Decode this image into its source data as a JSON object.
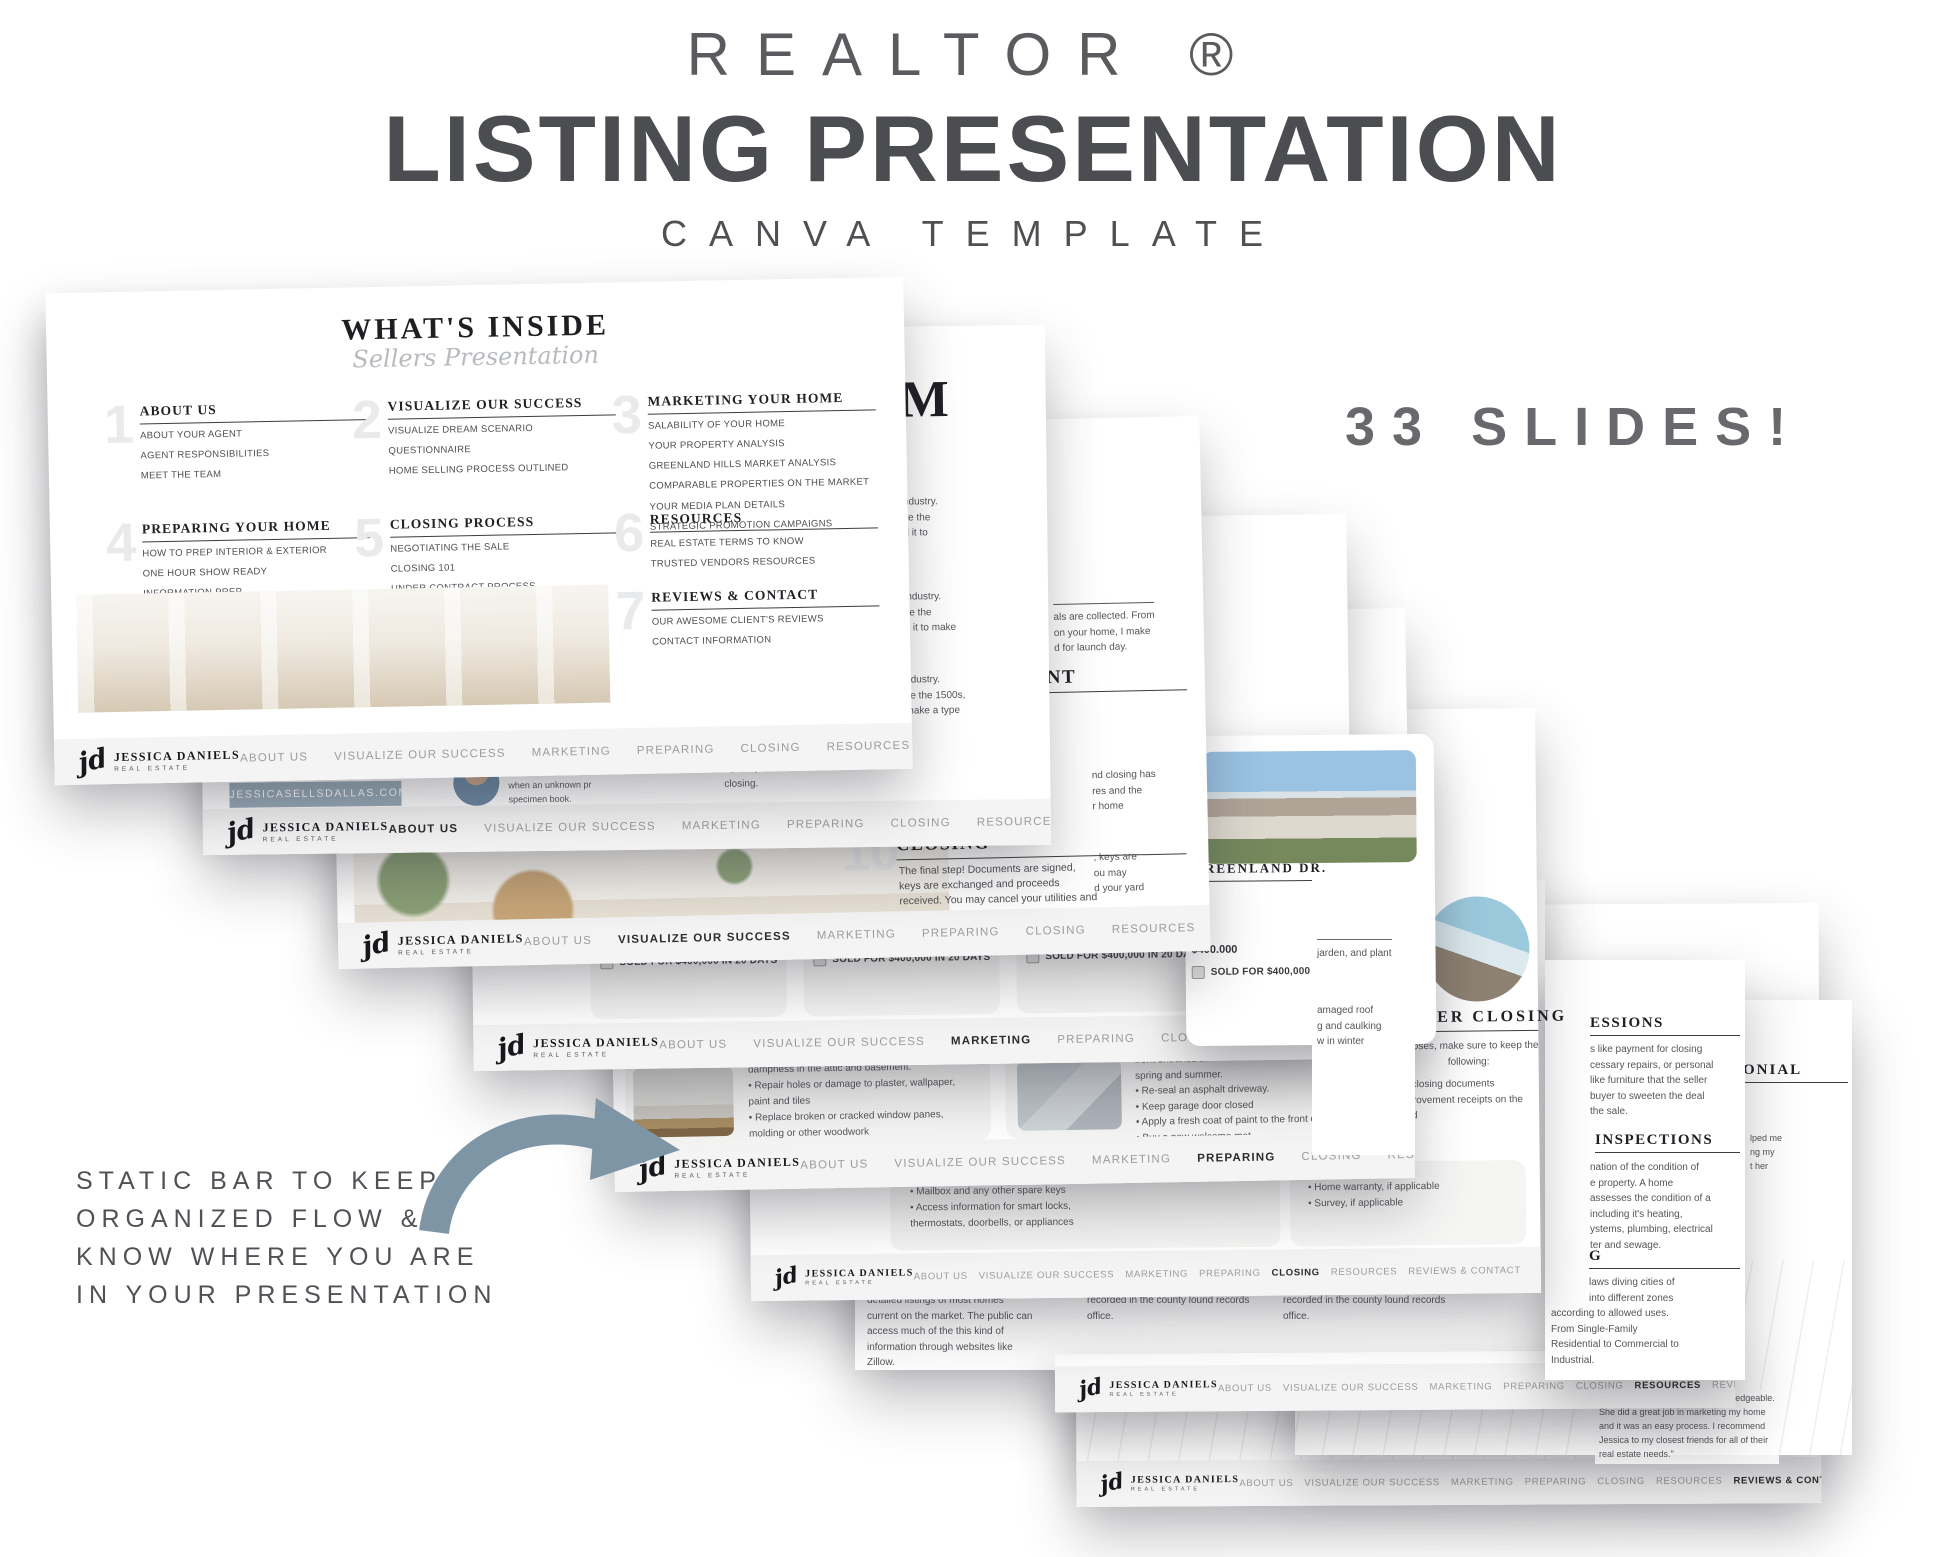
{
  "header": {
    "brand_line": "REALTOR ®",
    "title": "LISTING PRESENTATION",
    "subtitle": "CANVA TEMPLATE",
    "badge": "33 SLIDES!"
  },
  "annotation": {
    "line1": "STATIC BAR TO KEEP",
    "line2": "ORGANIZED FLOW &",
    "line3": "KNOW WHERE YOU ARE",
    "line4": "IN YOUR PRESENTATION",
    "arrow_color": "#7e95a6"
  },
  "brand": {
    "script": "jd",
    "name": "JESSICA DANIELS",
    "sub": "REAL ESTATE",
    "website": "JESSICASELLSDALLAS.COM",
    "social": [
      "facebook-icon",
      "pinterest-icon",
      "instagram-icon"
    ]
  },
  "nav": {
    "items": [
      "ABOUT US",
      "VISUALIZE OUR SUCCESS",
      "MARKETING",
      "PREPARING",
      "CLOSING",
      "RESOURCES",
      "REVIEWS & CONTACT"
    ]
  },
  "s1": {
    "title": "WHAT'S INSIDE",
    "subtitle": "Sellers Presentation",
    "sections": [
      {
        "num": "1",
        "title": "ABOUT US",
        "lines": [
          "ABOUT YOUR AGENT",
          "AGENT RESPONSIBILITIES",
          "MEET THE TEAM"
        ]
      },
      {
        "num": "2",
        "title": "VISUALIZE OUR SUCCESS",
        "lines": [
          "VISUALIZE DREAM SCENARIO",
          "QUESTIONNAIRE",
          "HOME SELLING PROCESS OUTLINED"
        ]
      },
      {
        "num": "3",
        "title": "MARKETING YOUR HOME",
        "lines": [
          "SALABILITY OF YOUR HOME",
          "YOUR PROPERTY ANALYSIS",
          "GREENLAND HILLS MARKET ANALYSIS",
          "COMPARABLE PROPERTIES ON THE MARKET",
          "YOUR MEDIA PLAN DETAILS",
          "STRATEGIC PROMOTION CAMPAIGNS"
        ]
      },
      {
        "num": "4",
        "title": "PREPARING YOUR HOME",
        "lines": [
          "HOW TO PREP INTERIOR & EXTERIOR",
          "ONE HOUR SHOW READY",
          "INFORMATION PREP"
        ]
      },
      {
        "num": "5",
        "title": "CLOSING PROCESS",
        "lines": [
          "NEGOTIATING THE SALE",
          "CLOSING 101",
          "UNDER CONTRACT PROCESS"
        ]
      },
      {
        "num": "6",
        "title": "RESOURCES",
        "lines": [
          "REAL ESTATE TERMS TO KNOW",
          "TRUSTED VENDORS RESOURCES"
        ]
      },
      {
        "num": "7",
        "title": "REVIEWS & CONTACT",
        "lines": [
          "OUR AWESOME CLIENT'S REVIEWS",
          "CONTACT INFORMATION"
        ]
      }
    ]
  },
  "s2": {
    "m_title": "M",
    "lorem1": [
      "ndustry.",
      "ce the",
      "d it to"
    ],
    "lorem2": [
      "industry.",
      "ce the",
      "d it to make"
    ],
    "lorem3": [
      "ndustry.",
      "ce the 1500s,",
      "make a type"
    ],
    "portrait": [
      "Lorem ipsum has bee",
      "when an unknown pr",
      "specimen book."
    ],
    "frag": [
      "ugh of your home",
      "closing."
    ]
  },
  "s3": {
    "step_num": "10",
    "step_title": "CLOSING",
    "step_body": "The final step! Documents are signed, keys are exchanged and proceeds received. You may cancel your utilities and insurance, and your yard sign is removed from your property.",
    "fragA": [
      "als are collected. From",
      "on your home, I make",
      "d for launch day."
    ],
    "fragB_title": "NT",
    "fragB": [
      "nd closing has",
      "res and the",
      "r home"
    ],
    "fragC": [
      ", keys are",
      "ou may",
      "d your yard"
    ]
  },
  "s4": {
    "sold": "SOLD FOR $400,000 IN 20 DAYS",
    "greenland": {
      "title": "GREENLAND DR.",
      "l1": "MS",
      "l2": "FT.",
      "price": "$400.000",
      "sold": "SOLD FOR $400,000 IN 20 DAYS"
    }
  },
  "s5": {
    "left": [
      "dampness in the attic and basement.",
      "• Repair holes or damage to plaster, wallpaper,",
      "paint and tiles",
      "• Replace broken or cracked window panes,",
      "molding or other woodwork"
    ],
    "right": [
      "front entrance in",
      "spring and summer.",
      "• Re-seal an asphalt driveway.",
      "• Keep garage door closed",
      "• Apply a fresh coat of paint to the front door",
      "• Buy a new welcome mat"
    ],
    "peek": [
      "jarden, and plant",
      "amaged roof",
      "g and caulking",
      "w in  winter"
    ]
  },
  "s6": {
    "left": [
      "• Mailbox and any other spare keys",
      "• Access information for smart locks,",
      "thermostats, doorbells, or appliances"
    ],
    "right": [
      "• Home warranty, if applicable",
      "• Survey, if applicable"
    ],
    "after": {
      "title": "AFTER CLOSING",
      "body1": "urposes, make sure to keep the",
      "body2": "following:",
      "items": [
        "all closing documents",
        "mprovement receipts on the",
        "sold"
      ]
    }
  },
  "s7": {
    "col1": [
      "detailed listings of most homes",
      "current on the market. The public can",
      "access much of the this kind of",
      "information through websites like",
      "Zillow."
    ],
    "col2": [
      "recorded in the county lound records",
      "office."
    ],
    "col3": [
      "recorded in the county lound records",
      "office."
    ]
  },
  "peek_right": {
    "impressions_title": "ESSIONS",
    "impressions": [
      "s like payment for closing",
      "cessary repairs, or personal",
      "like furniture that the seller",
      "buyer to sweeten the deal",
      "the sale."
    ],
    "inspections_title": "INSPECTIONS",
    "inspections": [
      "nation of the condition of",
      "e property. A home",
      "assesses the condition of a",
      "including it's heating,",
      "ystems, plumbing, electrical",
      "ter and sewage."
    ],
    "zoning_title": "G",
    "zoning": [
      "laws diving cities of",
      "into different zones",
      "according to allowed uses.",
      "From Single-Family",
      "Residential to Commercial to",
      "Industrial."
    ]
  },
  "s8": {
    "testimonial_title": "ONIAL",
    "frag": [
      "lped me",
      "ng my",
      "t her"
    ],
    "quote": [
      "\"Jessica is professional and knowledgeable.",
      "She did a great job in marketing my home",
      "and it was an easy process. I recommend",
      "Jessica to my closest friends for all of their",
      "real estate needs.\""
    ]
  }
}
